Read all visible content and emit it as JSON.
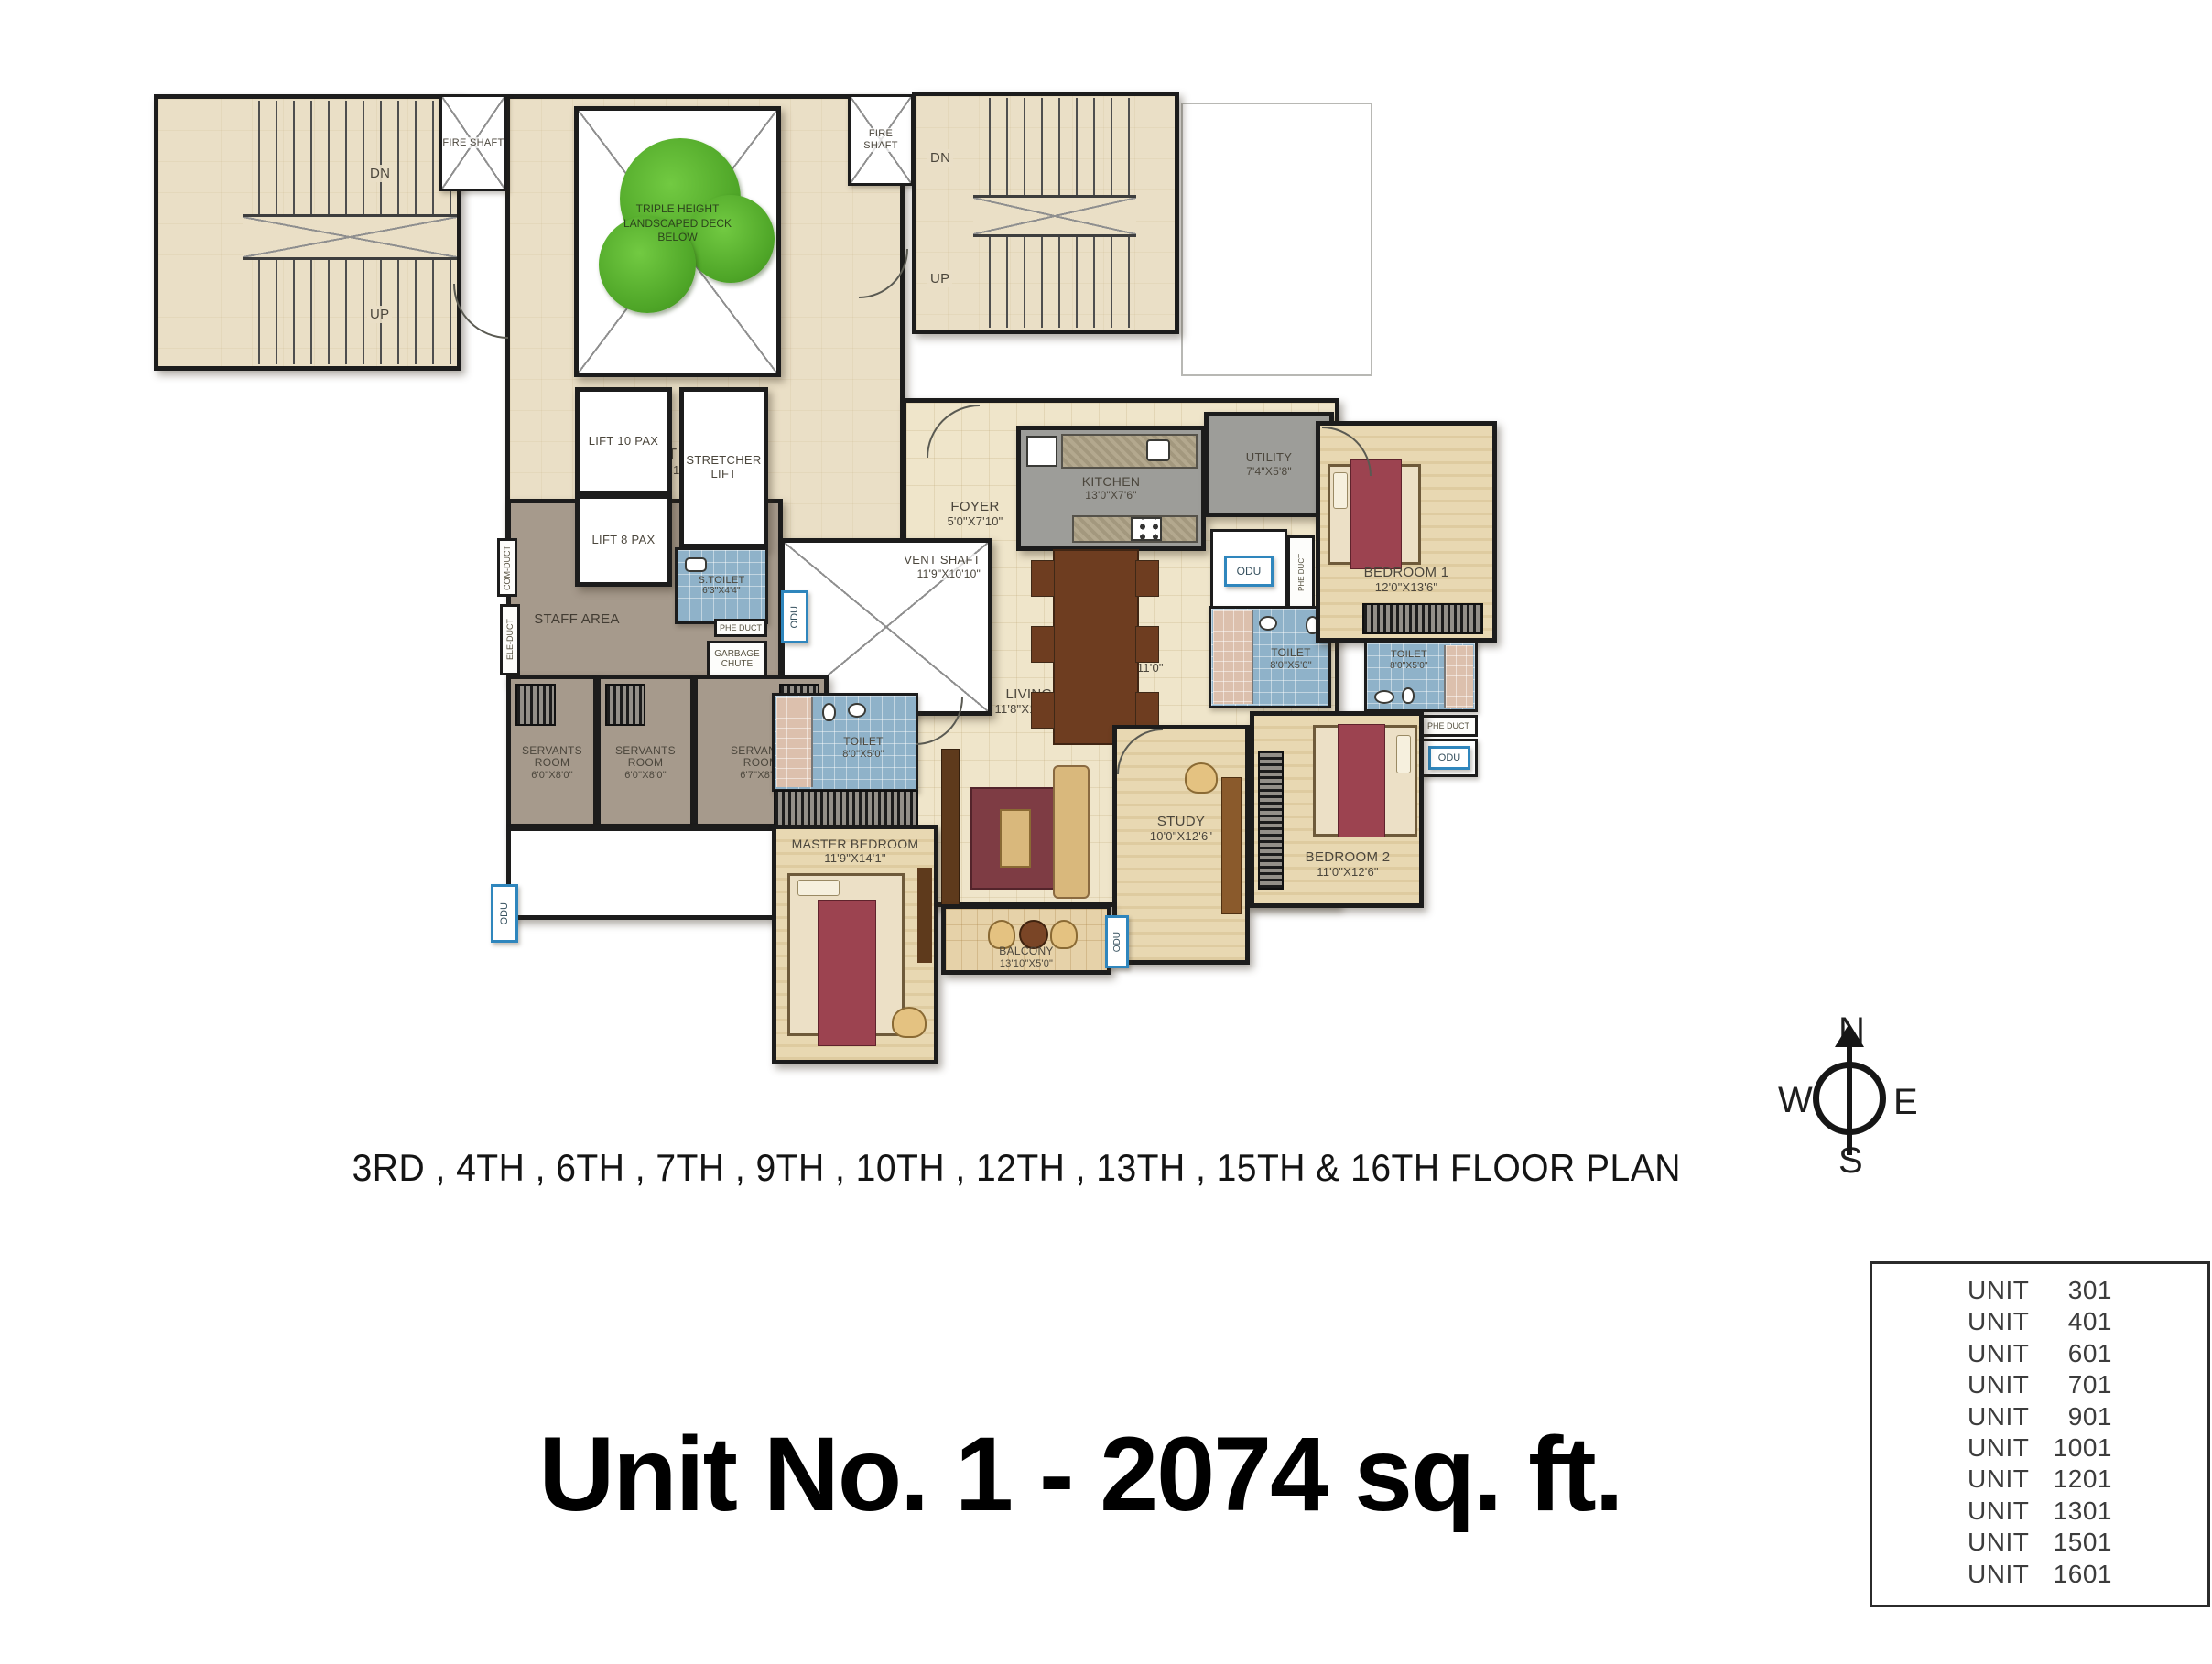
{
  "title": {
    "caption": "3RD , 4TH , 6TH , 7TH , 9TH , 10TH , 12TH , 13TH , 15TH & 16TH  FLOOR PLAN",
    "unit": "Unit No. 1 - 2074 sq. ft."
  },
  "compass": {
    "n": "N",
    "e": "E",
    "s": "S",
    "w": "W"
  },
  "plan": {
    "labels": {
      "dn": "DN",
      "up": "UP",
      "fire_shaft": "FIRE SHAFT",
      "odu": "ODU",
      "phe_duct": "PHE DUCT",
      "com_duct": "COM-DUCT",
      "ele_duct": "ELE-DUCT",
      "garbage_chute": "GARBAGE CHUTE",
      "staff_area": "STAFF AREA",
      "deck": "TRIPLE HEIGHT LANDSCAPED DECK BELOW"
    },
    "rooms": {
      "lift_lobby": {
        "name": "LIFT LOBBY",
        "dims": "24'11\"x 8'0\""
      },
      "lift10": {
        "name": "LIFT 10 PAX"
      },
      "stretcher": {
        "name": "STRETCHER LIFT"
      },
      "lift8": {
        "name": "LIFT 8 PAX"
      },
      "s_toilet": {
        "name": "S.TOILET",
        "dims": "6'3\"X4'4\""
      },
      "vent_shaft": {
        "name": "VENT SHAFT",
        "dims": "11'9\"X10'10\""
      },
      "servants": {
        "name": "SERVANTS ROOM",
        "dims_small": "6'0\"X8'0\"",
        "dims_large": "6'7\"X8'0\""
      },
      "toilet_8x5": {
        "name": "TOILET",
        "dims": "8'0\"X5'0\""
      },
      "master_bedroom": {
        "name": "MASTER BEDROOM",
        "dims": "11'9\"X14'1\""
      },
      "foyer": {
        "name": "FOYER",
        "dims": "5'0\"X7'10\""
      },
      "kitchen": {
        "name": "KITCHEN",
        "dims": "13'0\"X7'6\""
      },
      "utility": {
        "name": "UTILITY",
        "dims": "7'4\"X5'8\""
      },
      "bedroom1": {
        "name": "BEDROOM 1",
        "dims": "12'0\"X13'6\""
      },
      "living": {
        "name": "LIVING",
        "dims": "11'8\"X12'10\""
      },
      "dining": {
        "name": "DINING",
        "dims": "18'4\"X11'0\""
      },
      "study": {
        "name": "STUDY",
        "dims": "10'0\"X12'6\""
      },
      "bedroom2": {
        "name": "BEDROOM 2",
        "dims": "11'0\"X12'6\""
      },
      "balcony": {
        "name": "BALCONY",
        "dims": "13'10\"X5'0\""
      }
    }
  },
  "unit_table": {
    "rows": [
      {
        "label": "UNIT",
        "number": "301"
      },
      {
        "label": "UNIT",
        "number": "401"
      },
      {
        "label": "UNIT",
        "number": "601"
      },
      {
        "label": "UNIT",
        "number": "701"
      },
      {
        "label": "UNIT",
        "number": "901"
      },
      {
        "label": "UNIT",
        "number": "1001"
      },
      {
        "label": "UNIT",
        "number": "1201"
      },
      {
        "label": "UNIT",
        "number": "1301"
      },
      {
        "label": "UNIT",
        "number": "1501"
      },
      {
        "label": "UNIT",
        "number": "1601"
      }
    ]
  },
  "colors": {
    "wall": "#1c1c1c",
    "floor_beige": "#eadfc6",
    "floor_wood": "#e8d8b2",
    "staff_area": "#a69a8c",
    "kitchen_grey": "#9d9d99",
    "toilet_blue": "#8fb2c9",
    "tree_green": "#4ea527",
    "odu_accent": "#2f86bd"
  }
}
